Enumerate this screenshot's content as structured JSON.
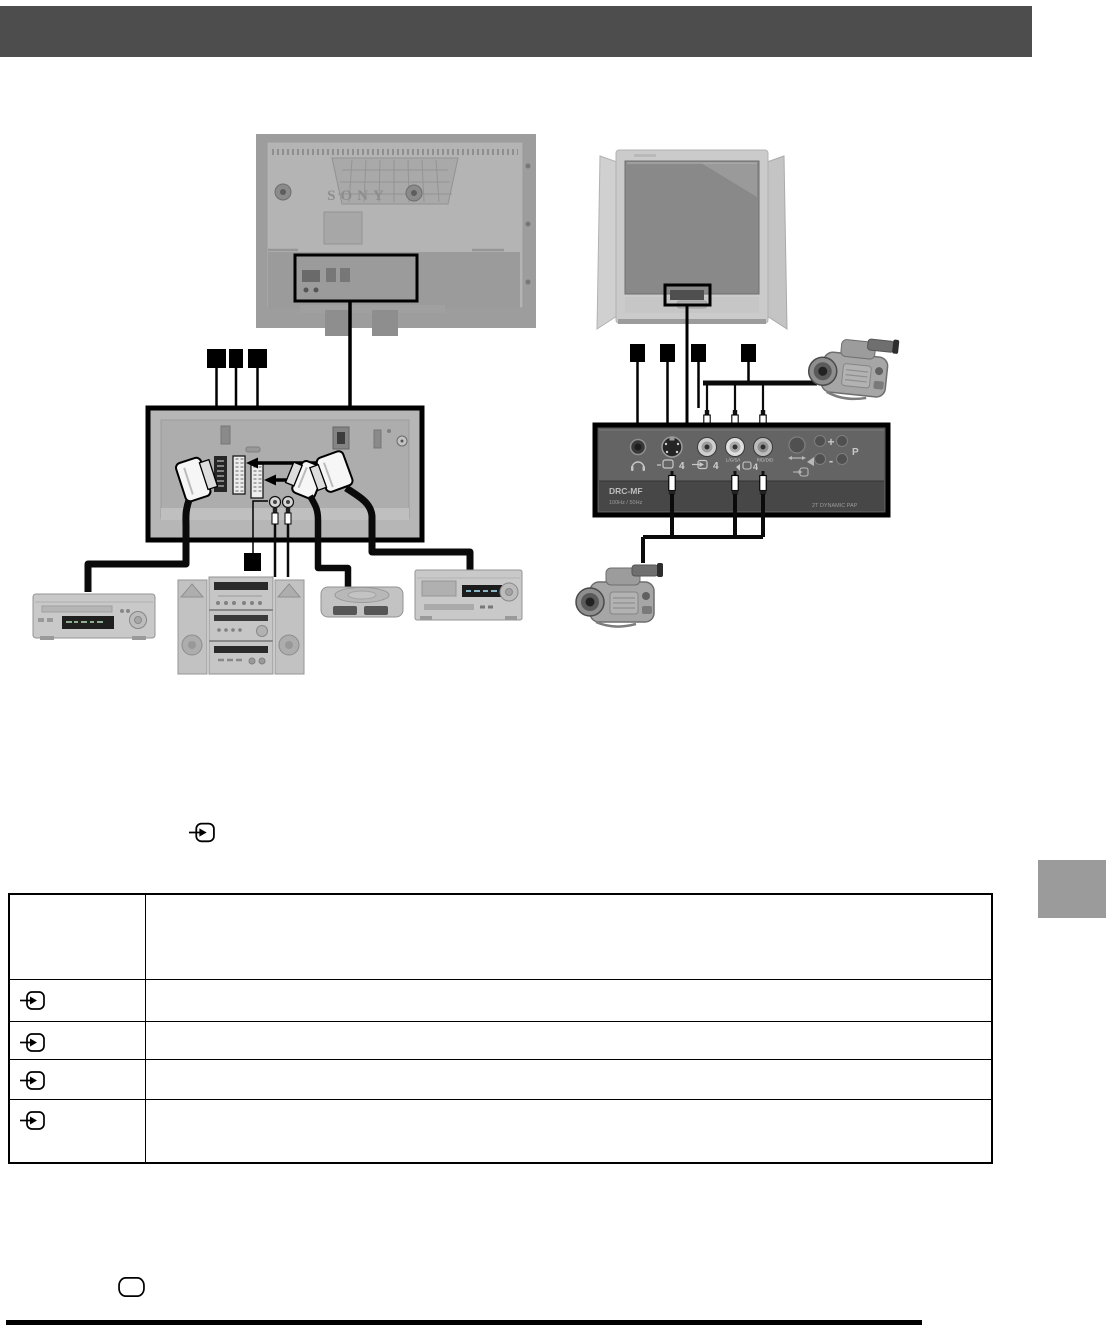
{
  "page": {
    "header_bar_color": "#4d4d4d",
    "side_tab_color": "#9b9b9b"
  },
  "rear_tv": {
    "brand": "SONY"
  },
  "front_panel": {
    "model": "DRC-MF",
    "refresh_rate": "100Hz / 50Hz",
    "feature": "2T DYNAMIC PAP",
    "svideo_input_number": "4",
    "video_input_number": "4",
    "audio_input_number": "4",
    "audio_left_label": "L/G/S/I",
    "audio_right_label": "R/D/D/D",
    "volume_up_label": "+",
    "volume_down_label": "-",
    "program_label": "P"
  },
  "icons": {
    "input_symbol": "input-icon",
    "headphone_symbol": "headphone-icon",
    "svideo_symbol": "s-video-icon",
    "speaker_symbol": "speaker-icon",
    "screen_symbol": "screen-shape-icon"
  },
  "table": {
    "header": {
      "symbol": "",
      "description": ""
    },
    "rows": [
      {
        "symbol_icon": "input-icon",
        "description": ""
      },
      {
        "symbol_icon": "input-icon",
        "description": ""
      },
      {
        "symbol_icon": "input-icon",
        "description": ""
      },
      {
        "symbol_icon": "input-icon",
        "description": ""
      }
    ]
  }
}
